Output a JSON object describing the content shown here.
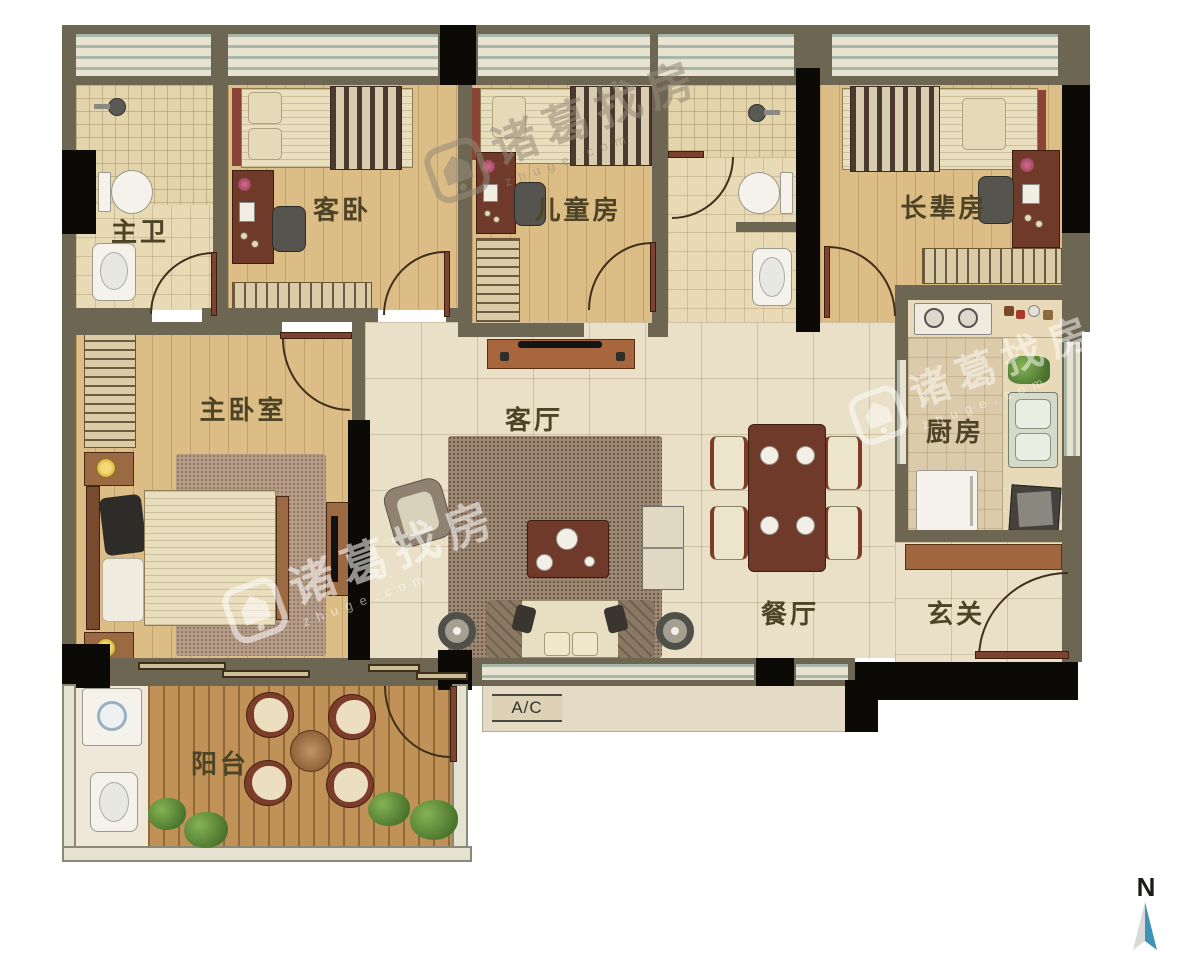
{
  "rooms": [
    {
      "id": "master-bath",
      "label": "主卫"
    },
    {
      "id": "guest-bedroom",
      "label": "客卧"
    },
    {
      "id": "kids-room",
      "label": "儿童房"
    },
    {
      "id": "elder-room",
      "label": "长辈房"
    },
    {
      "id": "master-bedroom",
      "label": "主卧室"
    },
    {
      "id": "living-room",
      "label": "客厅"
    },
    {
      "id": "kitchen",
      "label": "厨房"
    },
    {
      "id": "dining-room",
      "label": "餐厅"
    },
    {
      "id": "foyer",
      "label": "玄关"
    },
    {
      "id": "balcony",
      "label": "阳台"
    }
  ],
  "ac_unit": {
    "label": "A/C"
  },
  "compass": {
    "label": "N"
  },
  "watermark": {
    "text": "诸葛找房",
    "subtext": "zhuge.com"
  },
  "colors": {
    "wall_olive": "#6c6652",
    "wall_black": "#0c0a06",
    "wood_floor": "#dcbd85",
    "tile_floor": "#eae0c7",
    "deck_floor": "#c09257",
    "compass_blue": "#3f93b6",
    "compass_gray": "#d9d9d9",
    "label_text": "#4d4427"
  }
}
